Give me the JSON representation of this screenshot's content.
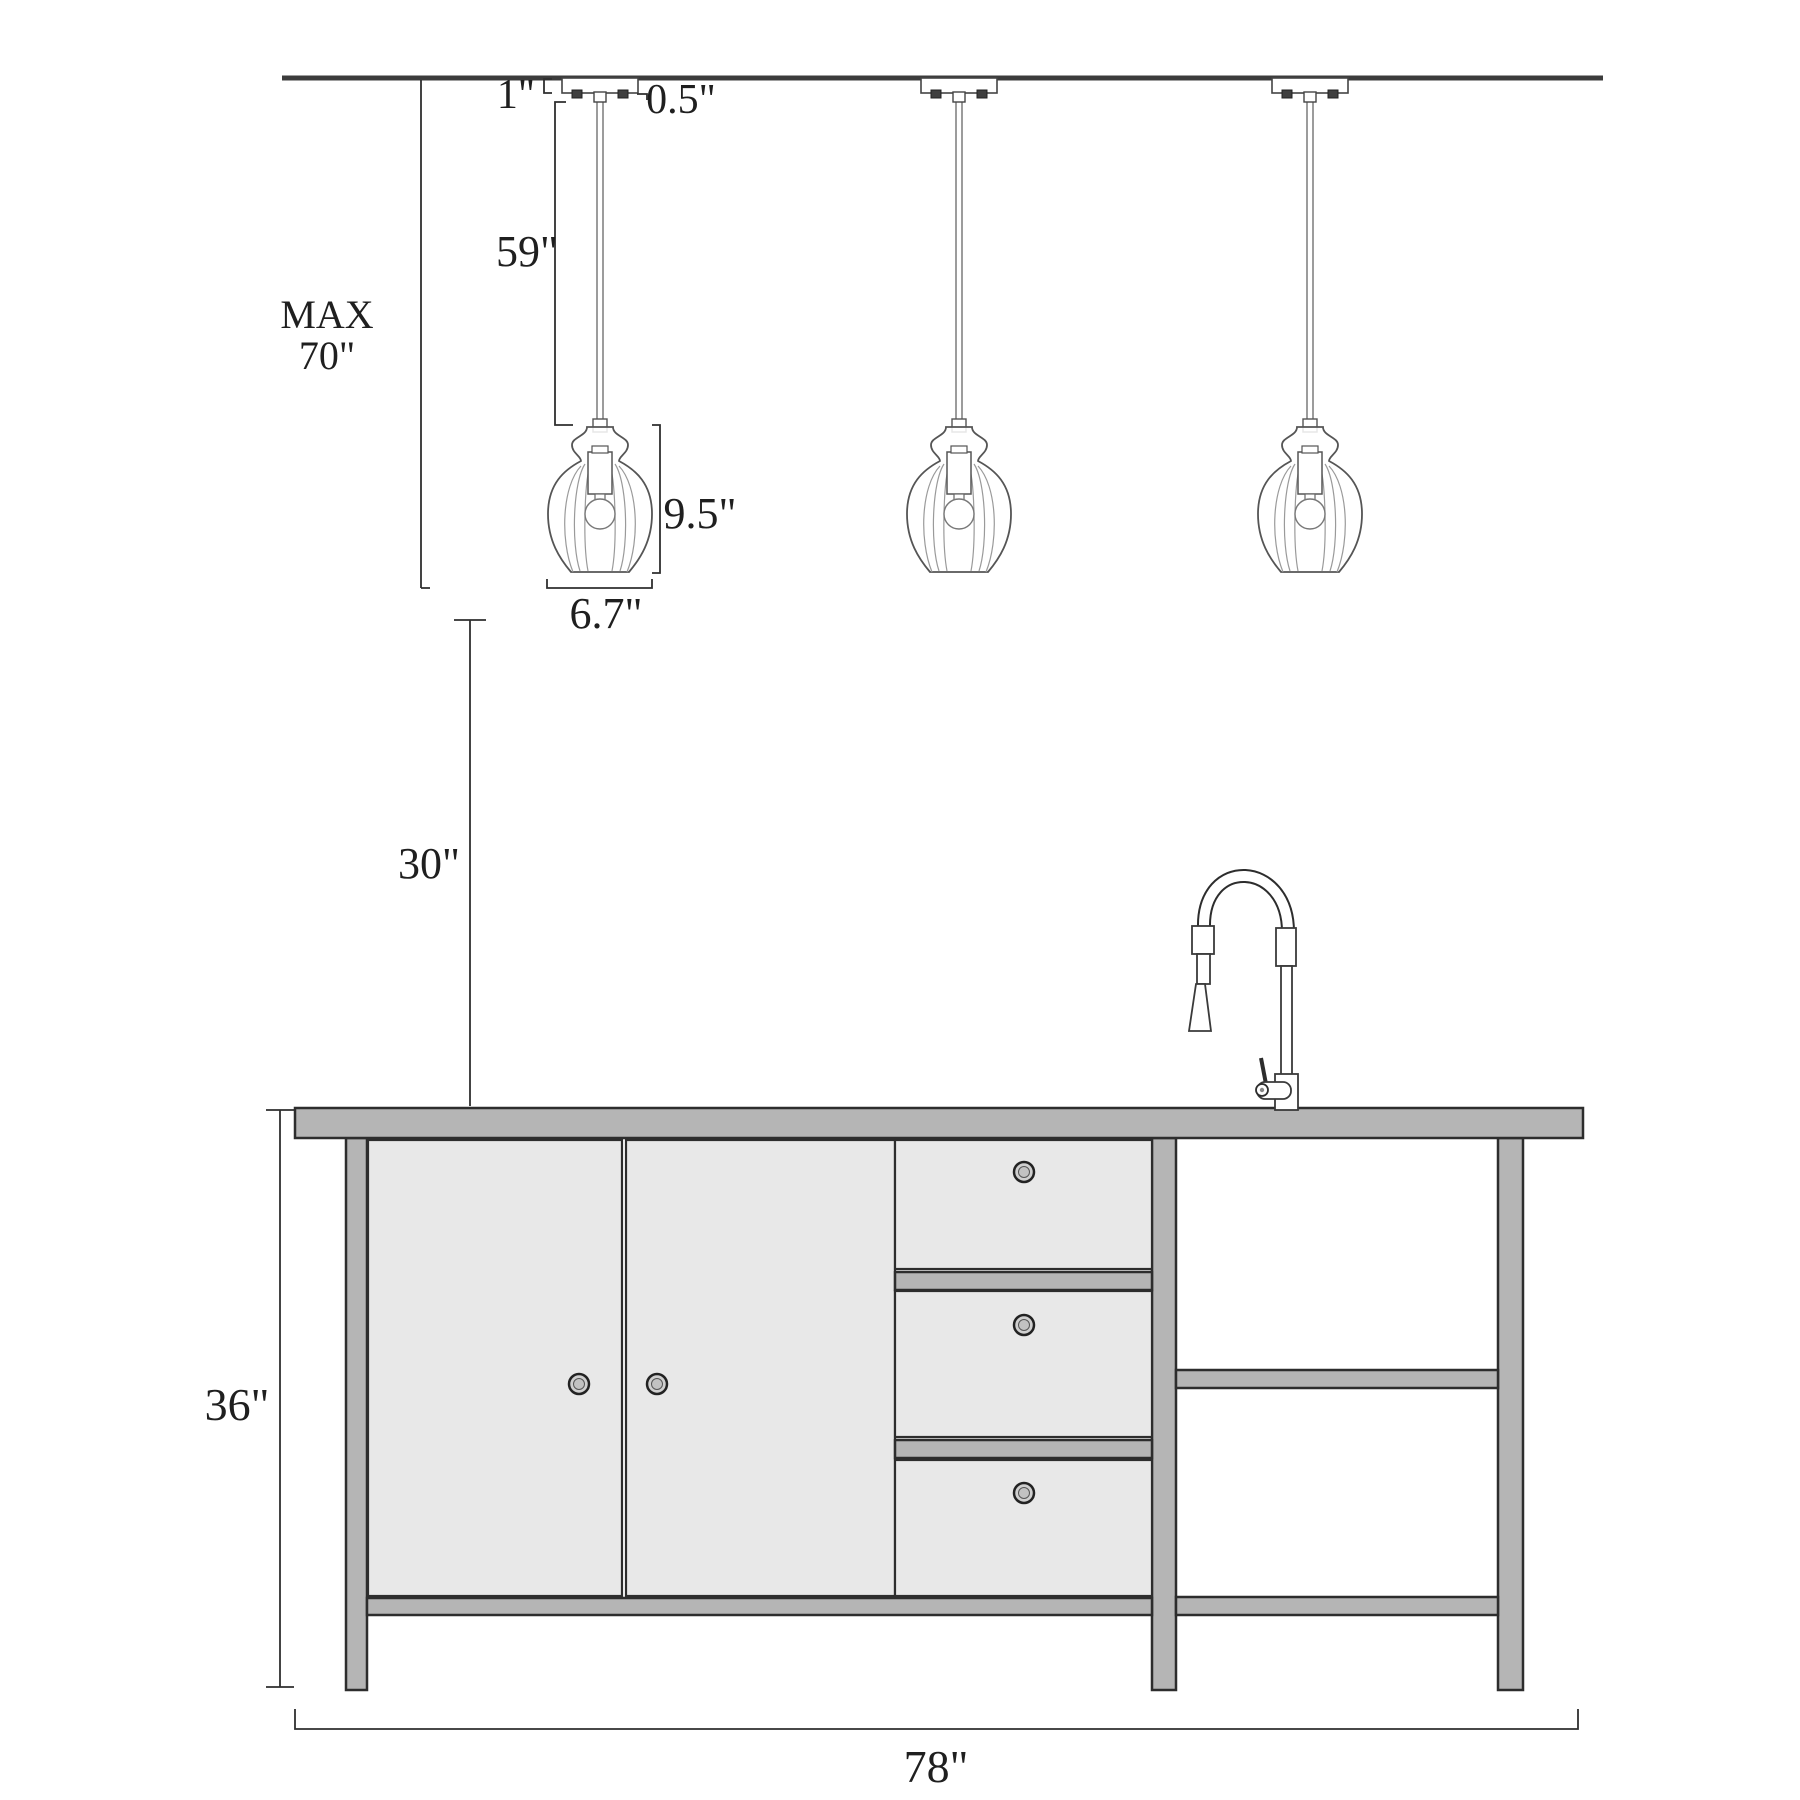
{
  "diagram": {
    "type": "pendant-light-kitchen-island-dimension-drawing",
    "background": "#ffffff",
    "colors": {
      "line": "#2d2d2d",
      "ceiling_line": "#3c3c3c",
      "gray_fill": "#b5b5b5",
      "light_face_fill": "#e8e8e8"
    },
    "fixtures": {
      "pendant_count": 3
    },
    "labels": {
      "canopy_height": "1\"",
      "stem_height": "0.5\"",
      "cord_length": "59\"",
      "max_drop_word": "MAX",
      "max_drop_value": "70\"",
      "shade_height": "9.5\"",
      "shade_diameter": "6.7\"",
      "counter_clearance": "30\"",
      "island_height": "36\"",
      "island_width": "78\""
    }
  }
}
